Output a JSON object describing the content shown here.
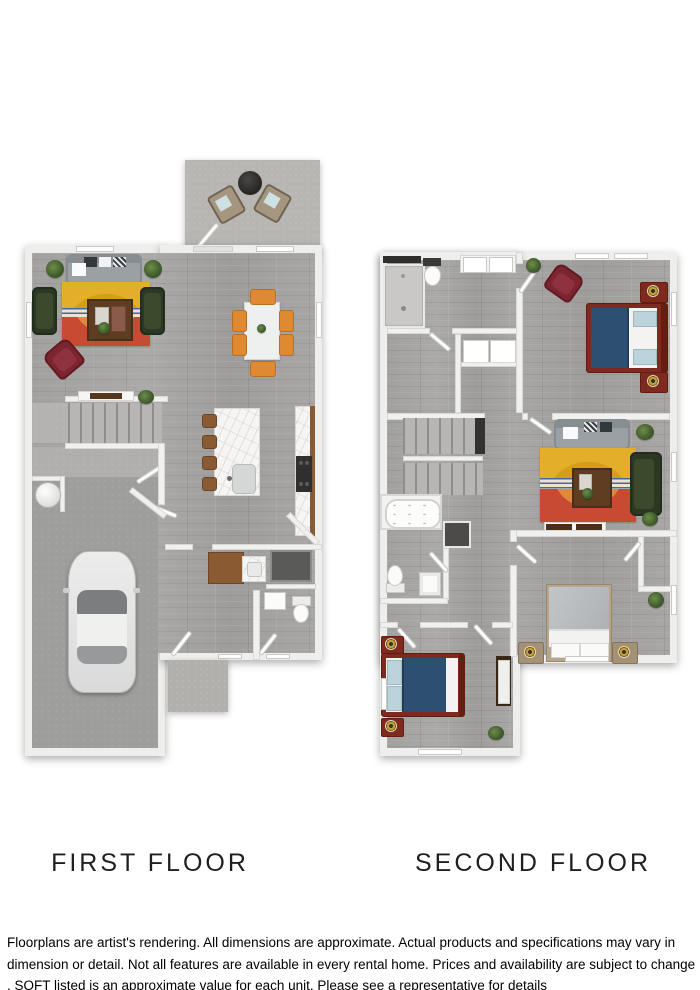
{
  "labels": {
    "first_floor": "FIRST FLOOR",
    "second_floor": "SECOND FLOOR"
  },
  "disclaimer": {
    "lines": [
      "Floorplans are artist's rendering. All dimensions are approximate. Actual products and specifications may vary in",
      "dimension or detail. Not all features are available in every rental home. Prices and availability are subject to change",
      ". SQFT listed is an approximate value for each unit. Please see a representative for details"
    ]
  },
  "colors": {
    "background": "#ffffff",
    "wood_floor": "#a6a5a3",
    "concrete": "#9e9e9c",
    "wall": "#f0f0ee",
    "rug_yellow": "#e3af2b",
    "rug_orange": "#db8a3f",
    "rug_red": "#c84a33",
    "rug_stripe_blue": "#46689b",
    "armchair_green": "#2c3823",
    "accent_maroon": "#7c2530",
    "dining_chair_orange": "#de8a33",
    "bed_duvet_blue": "#2d5072",
    "bed_frame_red": "#7e2a1e",
    "wood_furniture": "#5e3d22",
    "marble": "#f6f5f3",
    "label_text": "#1f1f1f"
  },
  "furniture_key": {
    "first_floor": [
      "patio-chairs",
      "patio-table",
      "gray-sofa",
      "area-rug",
      "green-armchairs",
      "coffee-table",
      "accent-chair",
      "tv-console",
      "dining-table",
      "dining-chairs",
      "kitchen-island",
      "bar-stools",
      "island-sink",
      "kitchen-counter",
      "range-stove",
      "stairs",
      "water-heater",
      "car",
      "vanity-cabinet",
      "toilet",
      "front-porch"
    ],
    "second_floor": [
      "walk-in-shower",
      "toilet",
      "double-vanity",
      "walk-in-closet",
      "linen-closet",
      "primary-bed",
      "nightstands",
      "table-lamps",
      "accent-chair",
      "gray-sofa",
      "area-rug",
      "green-sofa",
      "coffee-table",
      "tv-console",
      "stairs",
      "bathtub",
      "hall-toilet",
      "pedestal-sink",
      "bed-gray",
      "bed-blue",
      "dresser",
      "plants"
    ]
  }
}
